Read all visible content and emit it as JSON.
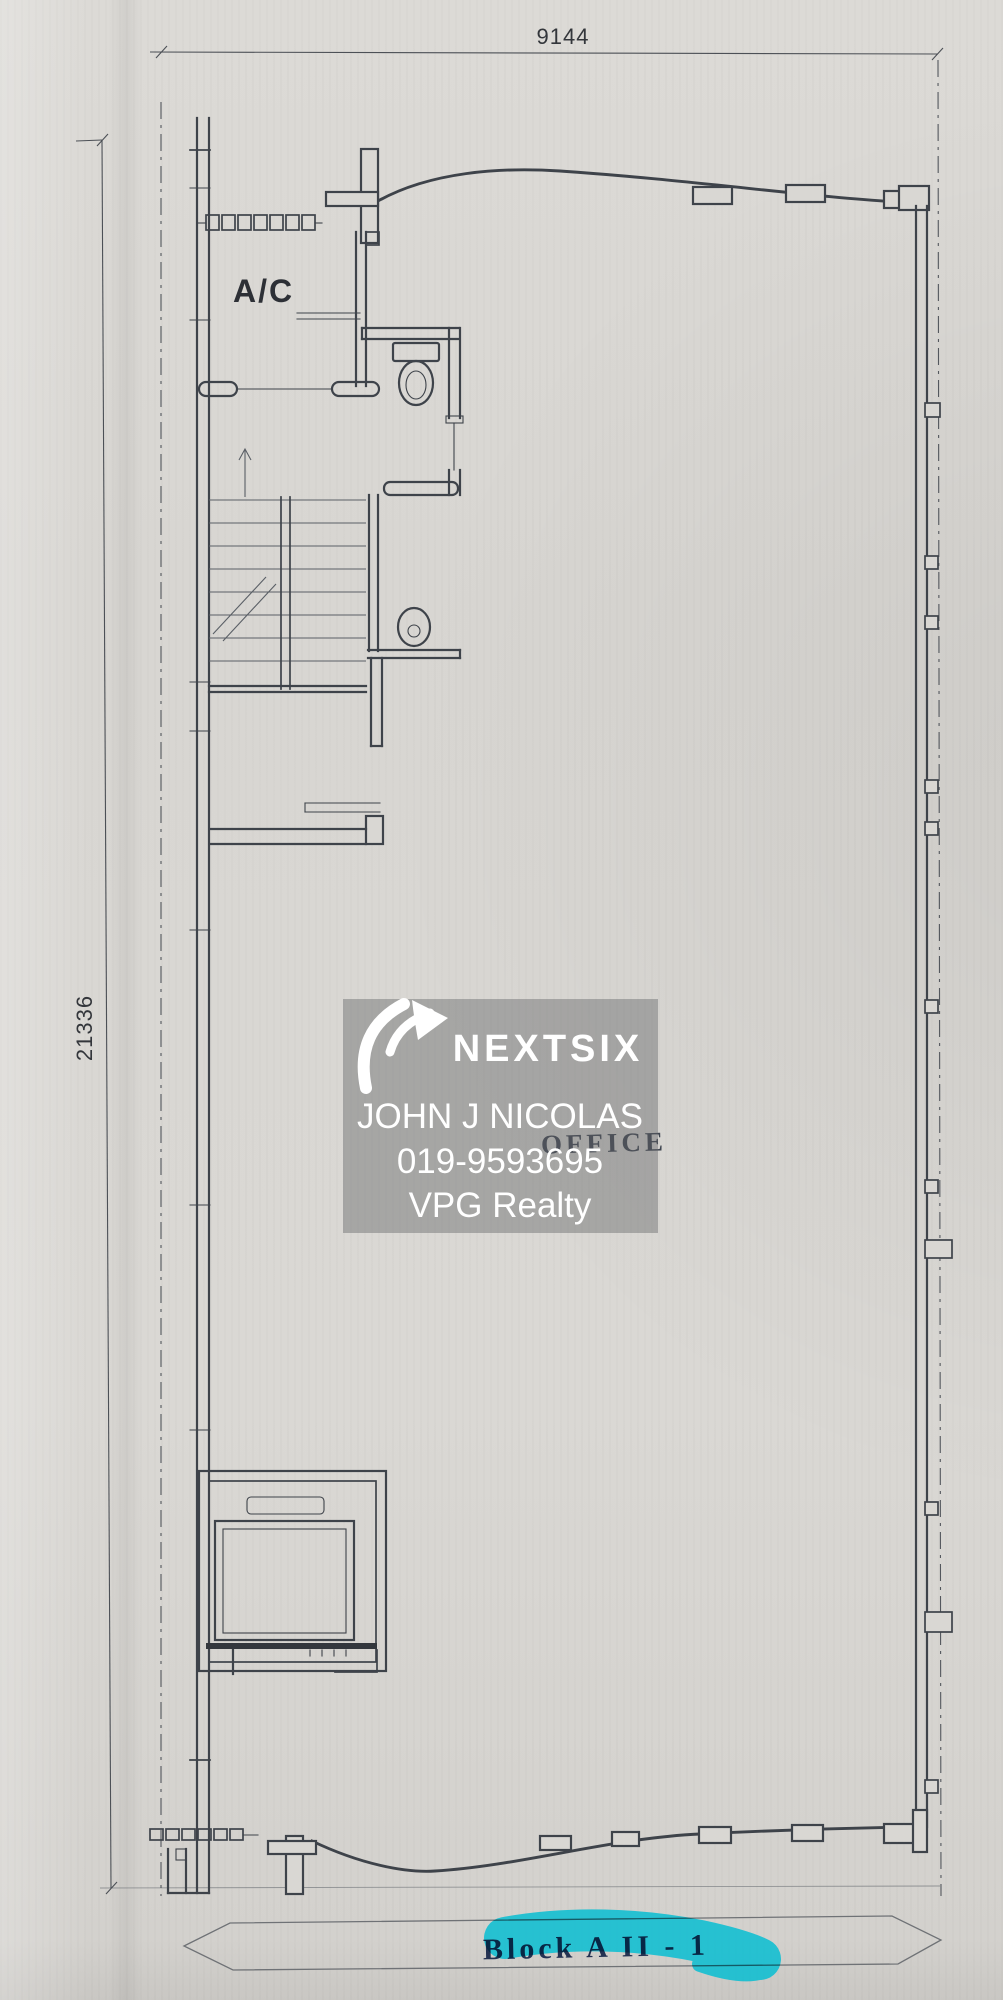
{
  "document": {
    "type_label": "floor-plan-scan",
    "dimensions": {
      "top_width": "9144",
      "left_height": "21336"
    },
    "labels": {
      "air_cond": "A/C",
      "room_stamp": "OFFICE",
      "block_title": "Block A II - 1"
    }
  },
  "watermark": {
    "brand": "NEXTSIX",
    "agent_name": "JOHN J NICOLAS",
    "phone": "019-9593695",
    "agency": "VPG Realty"
  },
  "colors": {
    "paper": "#d9d7d3",
    "ink": "#3e434a",
    "stamp": "#333a46",
    "block_text": "#243252",
    "highlight": "#00bdd2",
    "watermark_panel": "rgba(95,97,100,0.42)",
    "watermark_text": "#ffffff"
  }
}
